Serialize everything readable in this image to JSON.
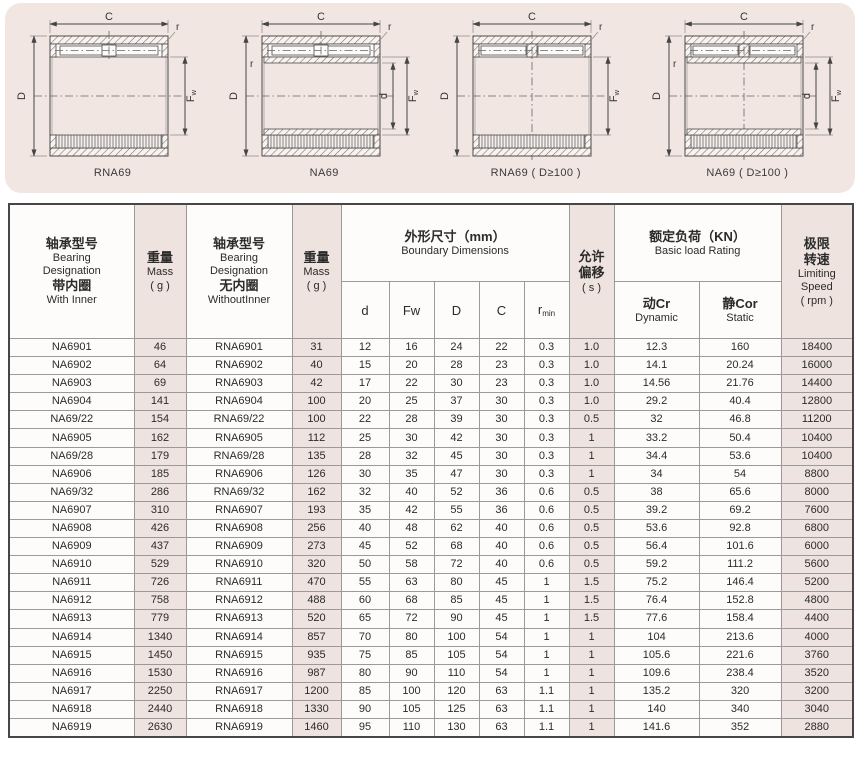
{
  "panel": {
    "bg": "#f2e6e2"
  },
  "colors": {
    "row_pink": "#eee3de",
    "line_dark": "#4a4a4a",
    "border": "#474747"
  },
  "dim_labels": {
    "C": "C",
    "D": "D",
    "d": "d",
    "Fw_base": "F",
    "Fw_sub": "w",
    "r": "r"
  },
  "diagrams": [
    {
      "caption": "RNA69",
      "type": "without-inner",
      "rows": 1
    },
    {
      "caption": "NA69",
      "type": "with-inner",
      "rows": 1
    },
    {
      "caption": "RNA69 ( D≥100 )",
      "type": "without-inner",
      "rows": 2
    },
    {
      "caption": "NA69 ( D≥100 )",
      "type": "with-inner",
      "rows": 2
    }
  ],
  "table": {
    "header": {
      "with_inner": {
        "zh1": "轴承型号",
        "en1": "Bearing",
        "en2": "Designation",
        "zh2": "带内圈",
        "en3": "With Inner"
      },
      "mass1": {
        "zh": "重量",
        "en": "Mass",
        "unit": "( g )"
      },
      "without_inner": {
        "zh1": "轴承型号",
        "en1": "Bearing",
        "en2": "Designation",
        "zh2": "无内圈",
        "en3": "WithoutInner"
      },
      "mass2": {
        "zh": "重量",
        "en": "Mass",
        "unit": "( g )"
      },
      "boundary": {
        "zh": "外形尺寸（mm）",
        "en": "Boundary Dimensions"
      },
      "dims": {
        "d": "d",
        "fw": "Fw",
        "D": "D",
        "C": "C",
        "rmin_base": "r",
        "rmin_sub": "min"
      },
      "allow": {
        "zh1": "允许",
        "zh2": "偏移",
        "unit": "( s )"
      },
      "load": {
        "zh": "额定负荷（KN）",
        "en": "Basic load Rating"
      },
      "dynamic": {
        "zh": "动Cr",
        "en": "Dynamic"
      },
      "static": {
        "zh": "静Cor",
        "en": "Static"
      },
      "speed": {
        "zh1": "极限",
        "zh2": "转速",
        "en1": "Limiting",
        "en2": "Speed",
        "unit": "( rpm )"
      }
    },
    "rows": [
      [
        "NA6901",
        "46",
        "RNA6901",
        "31",
        "12",
        "16",
        "24",
        "22",
        "0.3",
        "1.0",
        "12.3",
        "160",
        "18400"
      ],
      [
        "NA6902",
        "64",
        "RNA6902",
        "40",
        "15",
        "20",
        "28",
        "23",
        "0.3",
        "1.0",
        "14.1",
        "20.24",
        "16000"
      ],
      [
        "NA6903",
        "69",
        "RNA6903",
        "42",
        "17",
        "22",
        "30",
        "23",
        "0.3",
        "1.0",
        "14.56",
        "21.76",
        "14400"
      ],
      [
        "NA6904",
        "141",
        "RNA6904",
        "100",
        "20",
        "25",
        "37",
        "30",
        "0.3",
        "1.0",
        "29.2",
        "40.4",
        "12800"
      ],
      [
        "NA69/22",
        "154",
        "RNA69/22",
        "100",
        "22",
        "28",
        "39",
        "30",
        "0.3",
        "0.5",
        "32",
        "46.8",
        "11200"
      ],
      [
        "NA6905",
        "162",
        "RNA6905",
        "112",
        "25",
        "30",
        "42",
        "30",
        "0.3",
        "1",
        "33.2",
        "50.4",
        "10400"
      ],
      [
        "NA69/28",
        "179",
        "RNA69/28",
        "135",
        "28",
        "32",
        "45",
        "30",
        "0.3",
        "1",
        "34.4",
        "53.6",
        "10400"
      ],
      [
        "NA6906",
        "185",
        "RNA6906",
        "126",
        "30",
        "35",
        "47",
        "30",
        "0.3",
        "1",
        "34",
        "54",
        "8800"
      ],
      [
        "NA69/32",
        "286",
        "RNA69/32",
        "162",
        "32",
        "40",
        "52",
        "36",
        "0.6",
        "0.5",
        "38",
        "65.6",
        "8000"
      ],
      [
        "NA6907",
        "310",
        "RNA6907",
        "193",
        "35",
        "42",
        "55",
        "36",
        "0.6",
        "0.5",
        "39.2",
        "69.2",
        "7600"
      ],
      [
        "NA6908",
        "426",
        "RNA6908",
        "256",
        "40",
        "48",
        "62",
        "40",
        "0.6",
        "0.5",
        "53.6",
        "92.8",
        "6800"
      ],
      [
        "NA6909",
        "437",
        "RNA6909",
        "273",
        "45",
        "52",
        "68",
        "40",
        "0.6",
        "0.5",
        "56.4",
        "101.6",
        "6000"
      ],
      [
        "NA6910",
        "529",
        "RNA6910",
        "320",
        "50",
        "58",
        "72",
        "40",
        "0.6",
        "0.5",
        "59.2",
        "111.2",
        "5600"
      ],
      [
        "NA6911",
        "726",
        "RNA6911",
        "470",
        "55",
        "63",
        "80",
        "45",
        "1",
        "1.5",
        "75.2",
        "146.4",
        "5200"
      ],
      [
        "NA6912",
        "758",
        "RNA6912",
        "488",
        "60",
        "68",
        "85",
        "45",
        "1",
        "1.5",
        "76.4",
        "152.8",
        "4800"
      ],
      [
        "NA6913",
        "779",
        "RNA6913",
        "520",
        "65",
        "72",
        "90",
        "45",
        "1",
        "1.5",
        "77.6",
        "158.4",
        "4400"
      ],
      [
        "NA6914",
        "1340",
        "RNA6914",
        "857",
        "70",
        "80",
        "100",
        "54",
        "1",
        "1",
        "104",
        "213.6",
        "4000"
      ],
      [
        "NA6915",
        "1450",
        "RNA6915",
        "935",
        "75",
        "85",
        "105",
        "54",
        "1",
        "1",
        "105.6",
        "221.6",
        "3760"
      ],
      [
        "NA6916",
        "1530",
        "RNA6916",
        "987",
        "80",
        "90",
        "110",
        "54",
        "1",
        "1",
        "109.6",
        "238.4",
        "3520"
      ],
      [
        "NA6917",
        "2250",
        "RNA6917",
        "1200",
        "85",
        "100",
        "120",
        "63",
        "1.1",
        "1",
        "135.2",
        "320",
        "3200"
      ],
      [
        "NA6918",
        "2440",
        "RNA6918",
        "1330",
        "90",
        "105",
        "125",
        "63",
        "1.1",
        "1",
        "140",
        "340",
        "3040"
      ],
      [
        "NA6919",
        "2630",
        "RNA6919",
        "1460",
        "95",
        "110",
        "130",
        "63",
        "1.1",
        "1",
        "141.6",
        "352",
        "2880"
      ]
    ]
  }
}
